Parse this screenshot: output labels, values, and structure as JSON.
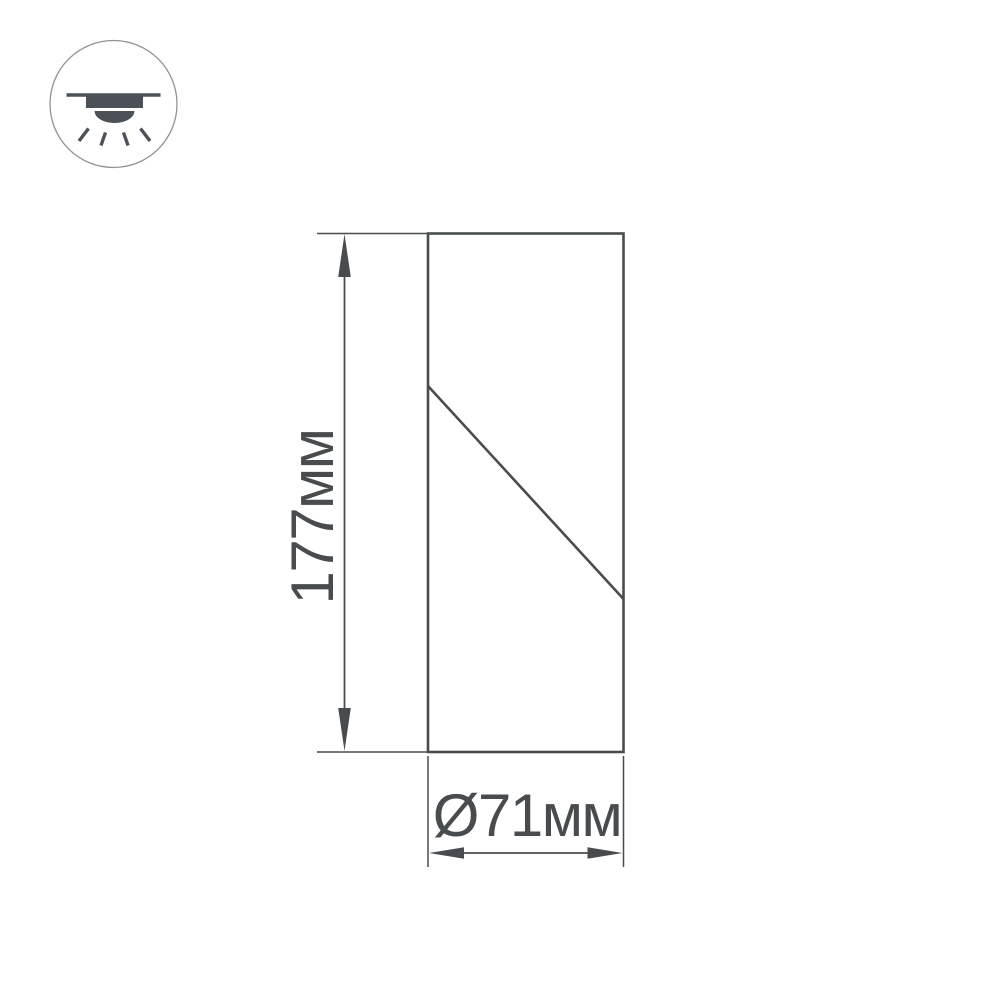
{
  "page": {
    "description": "Technical dimension drawing of a surface-mounted cylindrical ceiling spot light"
  },
  "icon": {
    "name": "surface-mounted-ceiling-light-icon"
  },
  "dimensions": {
    "height_label": "177мм",
    "height_mm": 177,
    "diameter_label": "Ø71мм",
    "diameter_mm": 71
  },
  "colors": {
    "line": "#494c4e",
    "icon": "#4b5157",
    "icon_border": "#8e9295",
    "background": "#ffffff"
  }
}
